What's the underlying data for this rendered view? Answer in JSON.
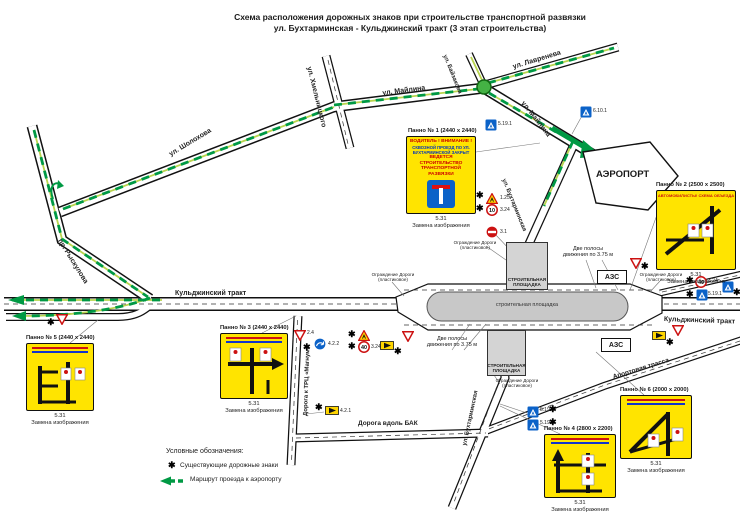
{
  "title": {
    "line1": "Схема расположения дорожных знаков при строительстве транспортной развязки",
    "line2": "ул. Бухтарминская - Кульджинский тракт (3 этап строительства)"
  },
  "streets": {
    "sholokhova": "ул. Шолохова",
    "ryskulova": "пр. Рыскулова",
    "khmelnitskogo": "ул. Хмельницкого",
    "maylina": "ул. Майлина",
    "bayzakova": "ул. Байзакова",
    "lavreneva": "ул. Лавренева",
    "bukhtarminskaya": "ул. Бухтарминская",
    "kuldzhinsky": "Кульджинский тракт",
    "trc_magnum": "Дорога к ТРЦ «Магнум»",
    "bak": "Дорога вдоль БАК",
    "aportovaya": "Апортовая трасса"
  },
  "places": {
    "airport": "АЭРОПОРТ",
    "azs": "АЗС",
    "site1": "СТРОИТЕЛЬНАЯ",
    "site2": "ПЛОЩАДКА",
    "site_oval": "строительная площадка"
  },
  "panels": {
    "code": "5.31",
    "note": "Замена изображения",
    "p1": {
      "label": "Панно № 1 (2440 х 2440)",
      "line1": "ВОДИТЕЛЬ !  ВНИМАНИЕ !",
      "line2": "СКВОЗНОЙ ПРОЕЗД ПО УЛ. БУХТАРМИНСКОЙ ЗАКРЫТ",
      "line3": "ВЕДЕТСЯ СТРОИТЕЛЬСТВО ТРАНСПОРТНОЙ РАЗВЯЗКИ"
    },
    "p2": {
      "label": "Панно № 2 (2500 х 2500)",
      "header": "АВТОМОБИЛИСТЫ! СХЕМА ОБЪЕЗДА"
    },
    "p3": {
      "label": "Панно № 3 (2440 х 2440)"
    },
    "p4": {
      "label": "Панно № 4 (2800 х 2200)"
    },
    "p5": {
      "label": "Панно № 5 (2440 х 2440)"
    },
    "p6": {
      "label": "Панно № 6 (2000 х 2000)"
    }
  },
  "notes": {
    "lanes1": "Две полосы",
    "lanes2": "движения по 3.75 м",
    "fence1": "Ограждение Дороги",
    "fence2": "(пластиковое)"
  },
  "legend": {
    "heading": "Условные обозначения:",
    "existing": "Существующие дорожные знаки",
    "route": "Маршрут проезда к аэропорту"
  },
  "signs": {
    "star": "✱",
    "speed10": "10",
    "speed40": "40",
    "codes": {
      "road_works": "1.25",
      "speed_limit": "3.24",
      "no_entry": "3.1",
      "give_way": "2.4",
      "detour_right": "4.2.1",
      "detour_left": "4.2.2",
      "crosswalk": "5.19.1",
      "crosswalk2": "5.19.2",
      "info": "6.10.1"
    }
  },
  "colors": {
    "panel_yellow": "#FFE400",
    "route_green": "#009944",
    "road_light_green": "#B8D44E",
    "construction_gray": "#C8C8C8"
  }
}
